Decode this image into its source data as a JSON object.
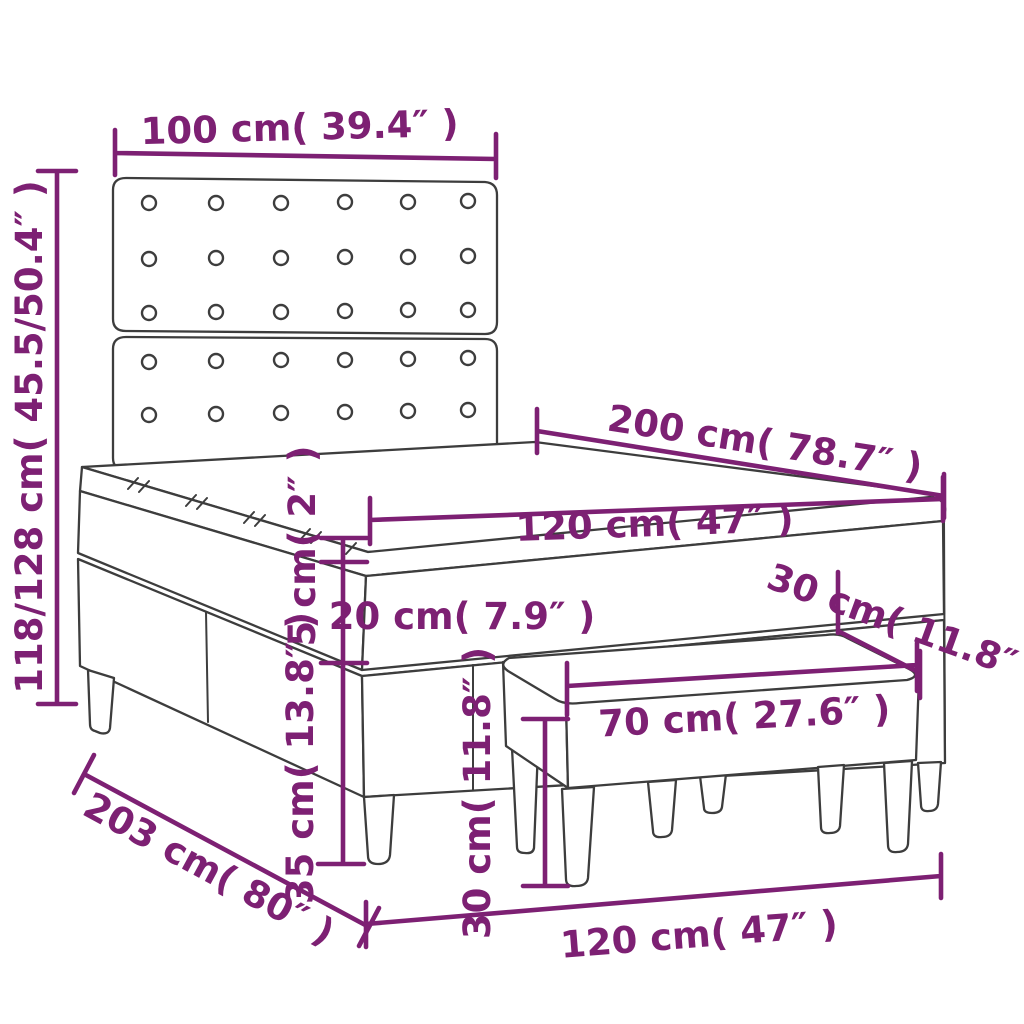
{
  "figure": {
    "kind": "product dimension diagram",
    "product": "box spring bed with tufted headboard, topper and upholstered bench",
    "background_color": "#FFFFFF",
    "accent_color": "#7D2073",
    "line_color": "#3D3D3D"
  },
  "headboard": {
    "button_columns": 6,
    "button_rows_upper_panel": 3,
    "button_rows_lower_panel": 2
  },
  "dimensions": {
    "headboard_width": "100 cm( 39.4″ )",
    "total_height_range": "118/128 cm( 45.5/50.4″ )",
    "mattress_length": "200 cm( 78.7″ )",
    "mattress_width": "120 cm( 47″ )",
    "topper_thickness": "5 cm( 2″ )",
    "mattress_thickness": "20 cm( 7.9″ )",
    "base_height": "35 cm( 13.8″ )",
    "bench_height": "30 cm( 11.8″ )",
    "bench_depth": "30 cm( 11.8″ )",
    "bench_length": "70 cm( 27.6″ )",
    "bed_width": "120 cm( 47″ )",
    "frame_length": "203 cm( 80″ )"
  }
}
